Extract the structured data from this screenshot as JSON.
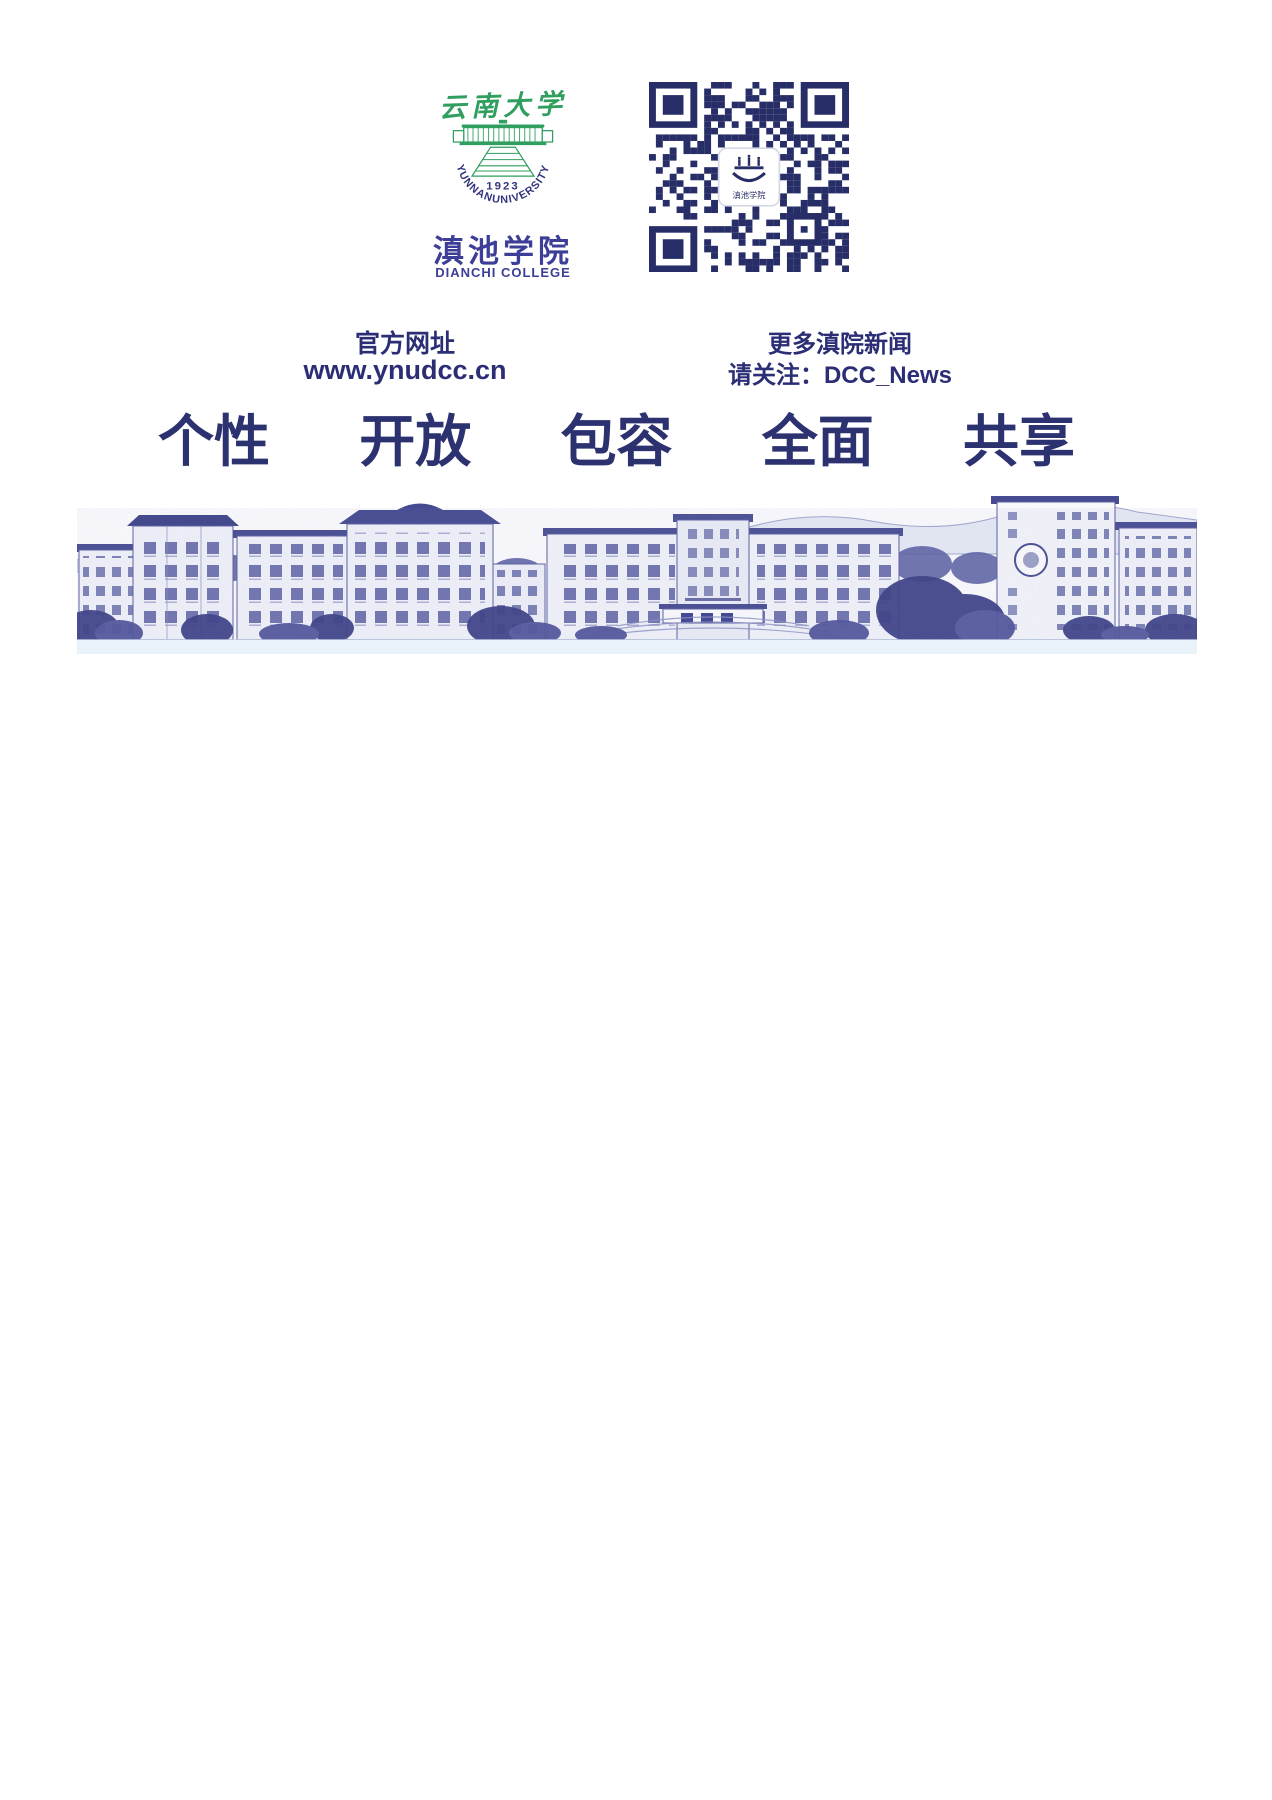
{
  "branding": {
    "calligraphy": "云南大学",
    "year": "1923",
    "university_arc": "YUNNANUNIVERSITY",
    "college_cn": "滇池学院",
    "college_en": "DIANCHI COLLEGE"
  },
  "links": {
    "website_label": "官方网址",
    "website_url": "www.ynudcc.cn"
  },
  "wechat": {
    "news_label": "更多滇院新闻",
    "follow_label": "请关注：DCC_News",
    "qr_center_text": "滇池学院"
  },
  "slogan": {
    "items": [
      "个性",
      "开放",
      "包容",
      "全面",
      "共享"
    ]
  },
  "colors": {
    "caption_navy": "#2b2e75",
    "slogan_navy": "#2c3170",
    "college_blue": "#3c3e97",
    "logo_green": "#2f9e5f",
    "qr_navy": "#272d66",
    "illustration_indigo": "#3e4390",
    "bottom_strip_blue": "#e9f1f9"
  }
}
